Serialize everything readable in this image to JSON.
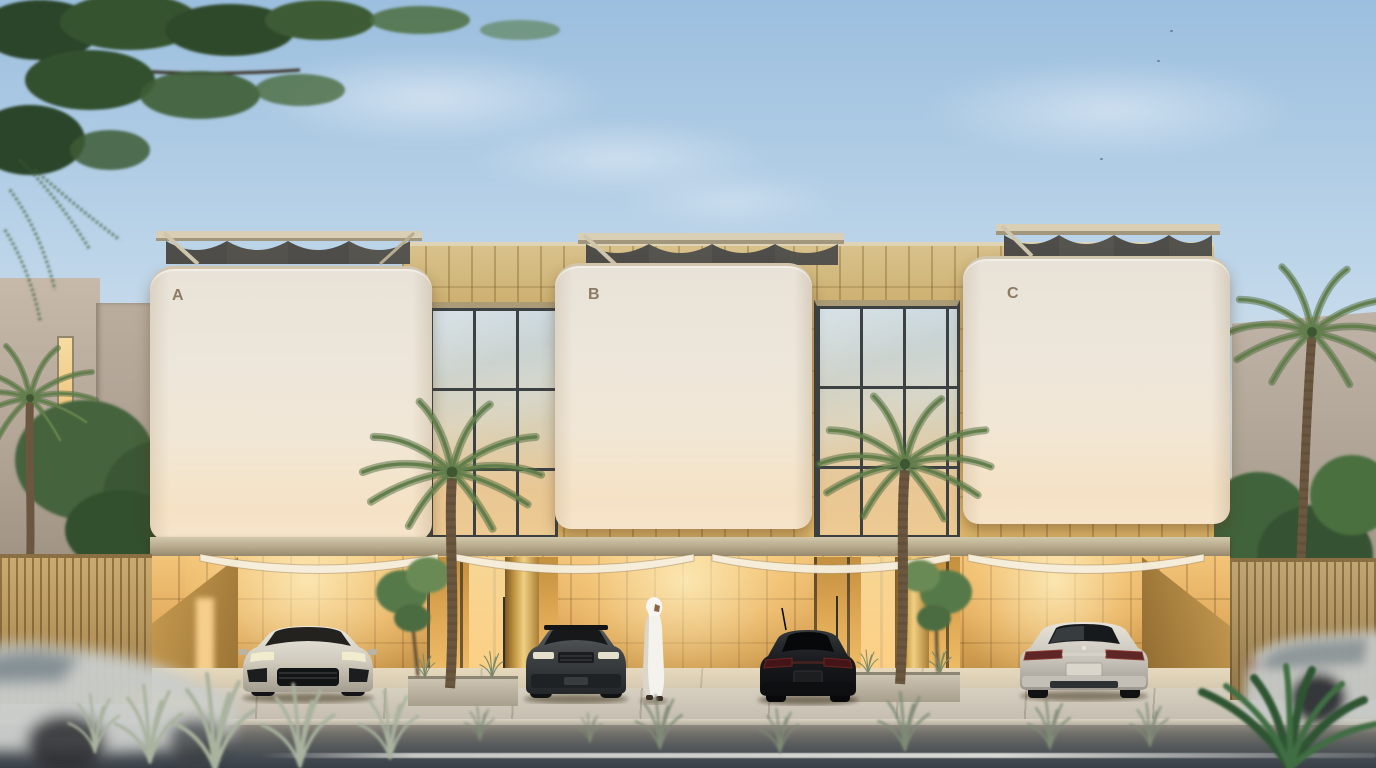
{
  "scene": {
    "title": "Twilight architectural rendering of a three-unit modern villa terrace",
    "setting": "street-front elevation with parked luxury cars, courtyard palms, slatted fences and passing traffic",
    "time_of_day": "dusk"
  },
  "units": [
    {
      "label": "A"
    },
    {
      "label": "B"
    },
    {
      "label": "C"
    }
  ],
  "colors": {
    "sky_top": "#9cbfdf",
    "sky_horizon": "#ecedee",
    "volume_plaster": "#f0e7d8",
    "volume_glow": "#f6e3c8",
    "stone_gold": "#d0a95f",
    "stone_gold_lit": "#f2c478",
    "wood_fence": "#bb9a5f",
    "glass_mullion": "#3c4144",
    "glass_warm": "#edca91",
    "glass_sky_reflection": "#c5d4dc",
    "road_asphalt": "#434950",
    "sidewalk_concrete": "#c9c2b3",
    "palm_green": "#5d7c4c",
    "tree_green": "#3d5c36"
  },
  "vehicles": {
    "parked": [
      {
        "name": "silver-suv-front",
        "description": "silver luxury SUV parked facing the street, unit A bay"
      },
      {
        "name": "grey-suv-front",
        "description": "dark grey SUV parked facing the street, unit B bay"
      },
      {
        "name": "black-sedan-rear",
        "description": "black sedan parked nose-in, seen from the rear"
      },
      {
        "name": "silver-sedan-rear",
        "description": "silver luxury sedan parked nose-in, unit C bay"
      }
    ],
    "passing": [
      {
        "name": "blurred-car-left",
        "description": "motion-blurred silver car driving past, lower left"
      },
      {
        "name": "blurred-car-right",
        "description": "motion-blurred silver car driving past, lower right"
      }
    ]
  },
  "person": {
    "name": "man-in-white-kandura",
    "description": "man in white kandura and ghutra walking along the parking apron"
  },
  "vegetation": [
    "overhanging leafy branch, top left",
    "two courtyard palm trees in planters",
    "leafy trees flanking both sides",
    "tall palm beside right neighbour wall",
    "roadside grass tufts",
    "dark fan plant, bottom right corner"
  ],
  "architecture": [
    "three cream plaster volumes with rounded corners labelled A, B, C",
    "rooftop pergolas with scalloped louvres",
    "golden stone panel band and ground-floor stone walls, warmly uplit",
    "double-height glazed links between volumes",
    "draped fabric canopies over the car bays",
    "vertical timber slat fences",
    "concrete sidewalk, curb and asphalt road with white lane line"
  ]
}
